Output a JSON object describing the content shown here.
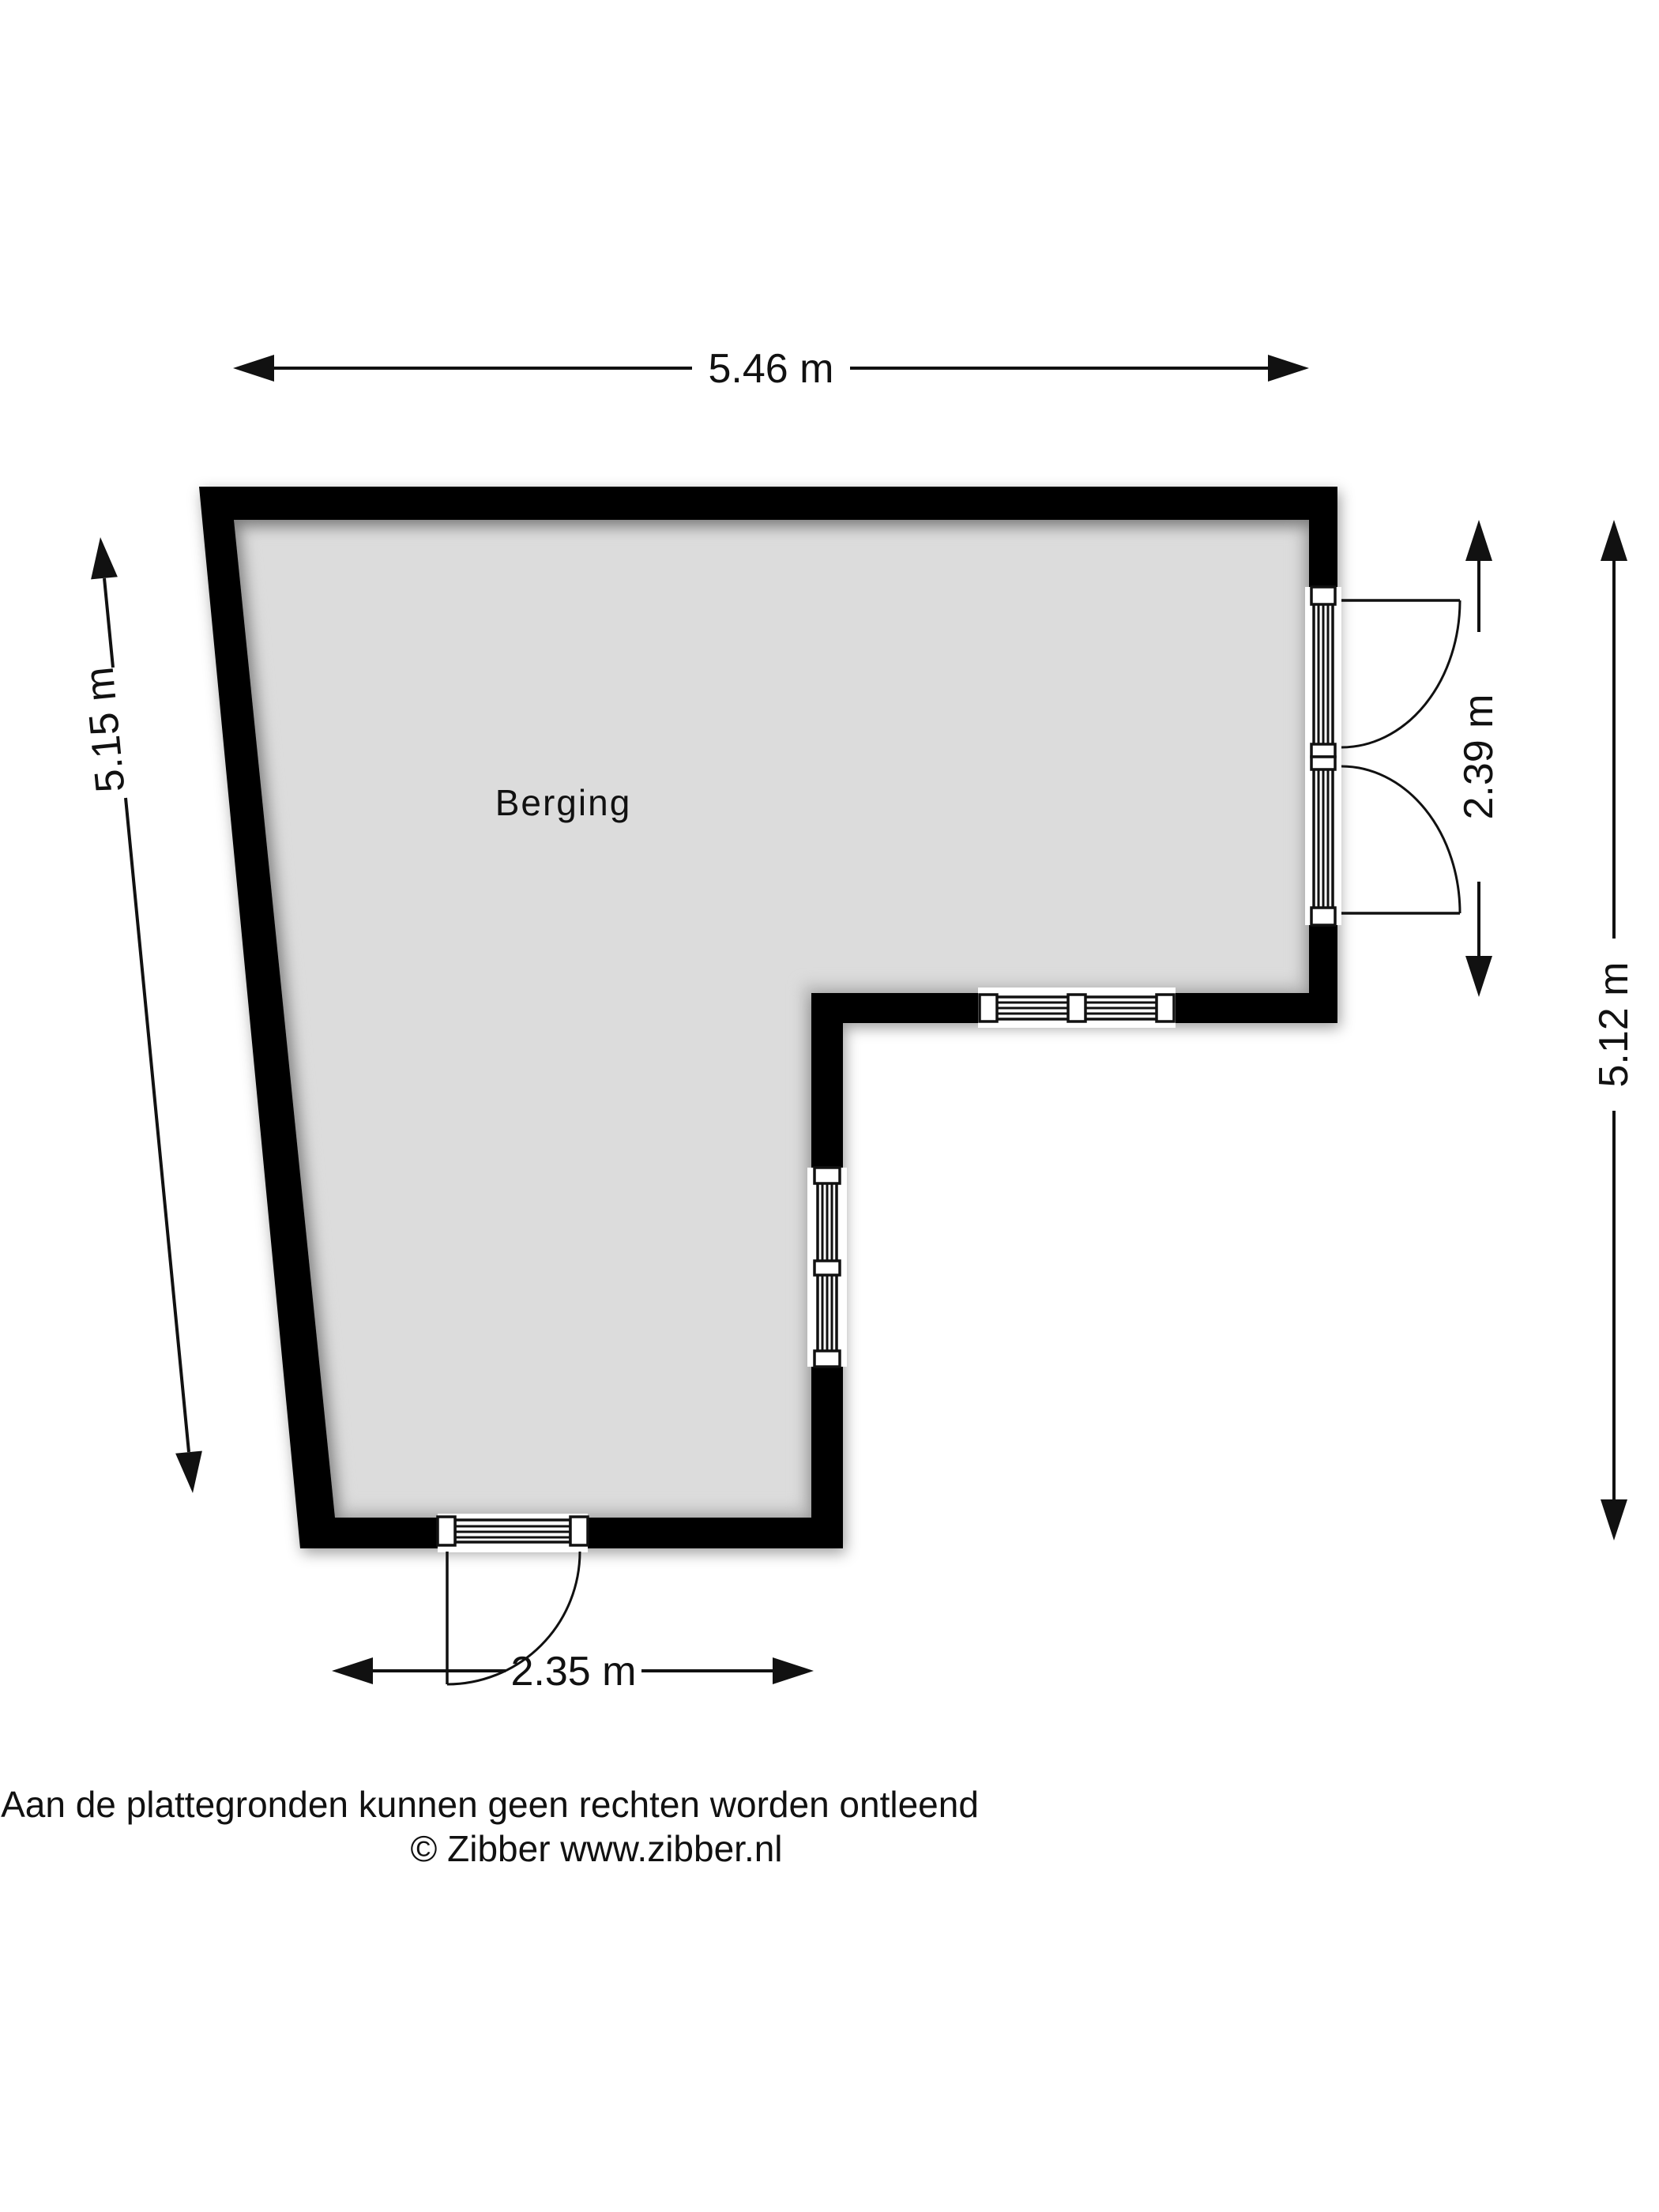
{
  "room": {
    "label": "Berging"
  },
  "dimensions": {
    "top": "5.46 m",
    "left": "5.15 m",
    "door_right": "2.39 m",
    "right": "5.12 m",
    "bottom": "2.35 m"
  },
  "openings": {
    "right_wall": "double-doors-outward",
    "mid_wall": "window",
    "step_wall": "window",
    "bottom_wall": "single-door-outward"
  },
  "footer": {
    "disclaimer": "Aan de plattegronden kunnen geen rechten worden ontleend",
    "copyright": "© Zibber www.zibber.nl"
  },
  "colors": {
    "wall": "#000000",
    "floor": "#dcdcdc",
    "line": "#111111",
    "background": "#ffffff"
  }
}
